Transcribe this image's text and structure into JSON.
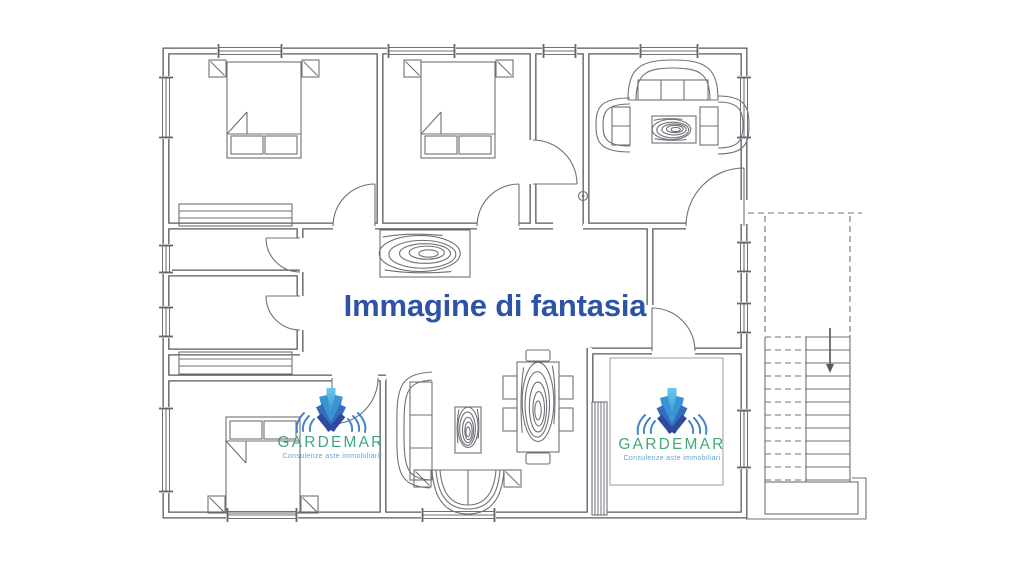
{
  "watermark": {
    "text": "Immagine di fantasia",
    "color": "#2d53a6"
  },
  "logo": {
    "brand": "GARDEMAR",
    "tagline": "Consulenze aste immobiliari",
    "brand_color": "#36a377",
    "tagline_color": "#5f9bd8",
    "arc_color": "#3a80c6",
    "fan_colors": [
      "#4cb9e8",
      "#2f8ed2",
      "#2a67b8",
      "#253f98"
    ]
  },
  "plan": {
    "wall_color": "#55585e",
    "line_color": "#6e7176",
    "background": "#ffffff"
  }
}
